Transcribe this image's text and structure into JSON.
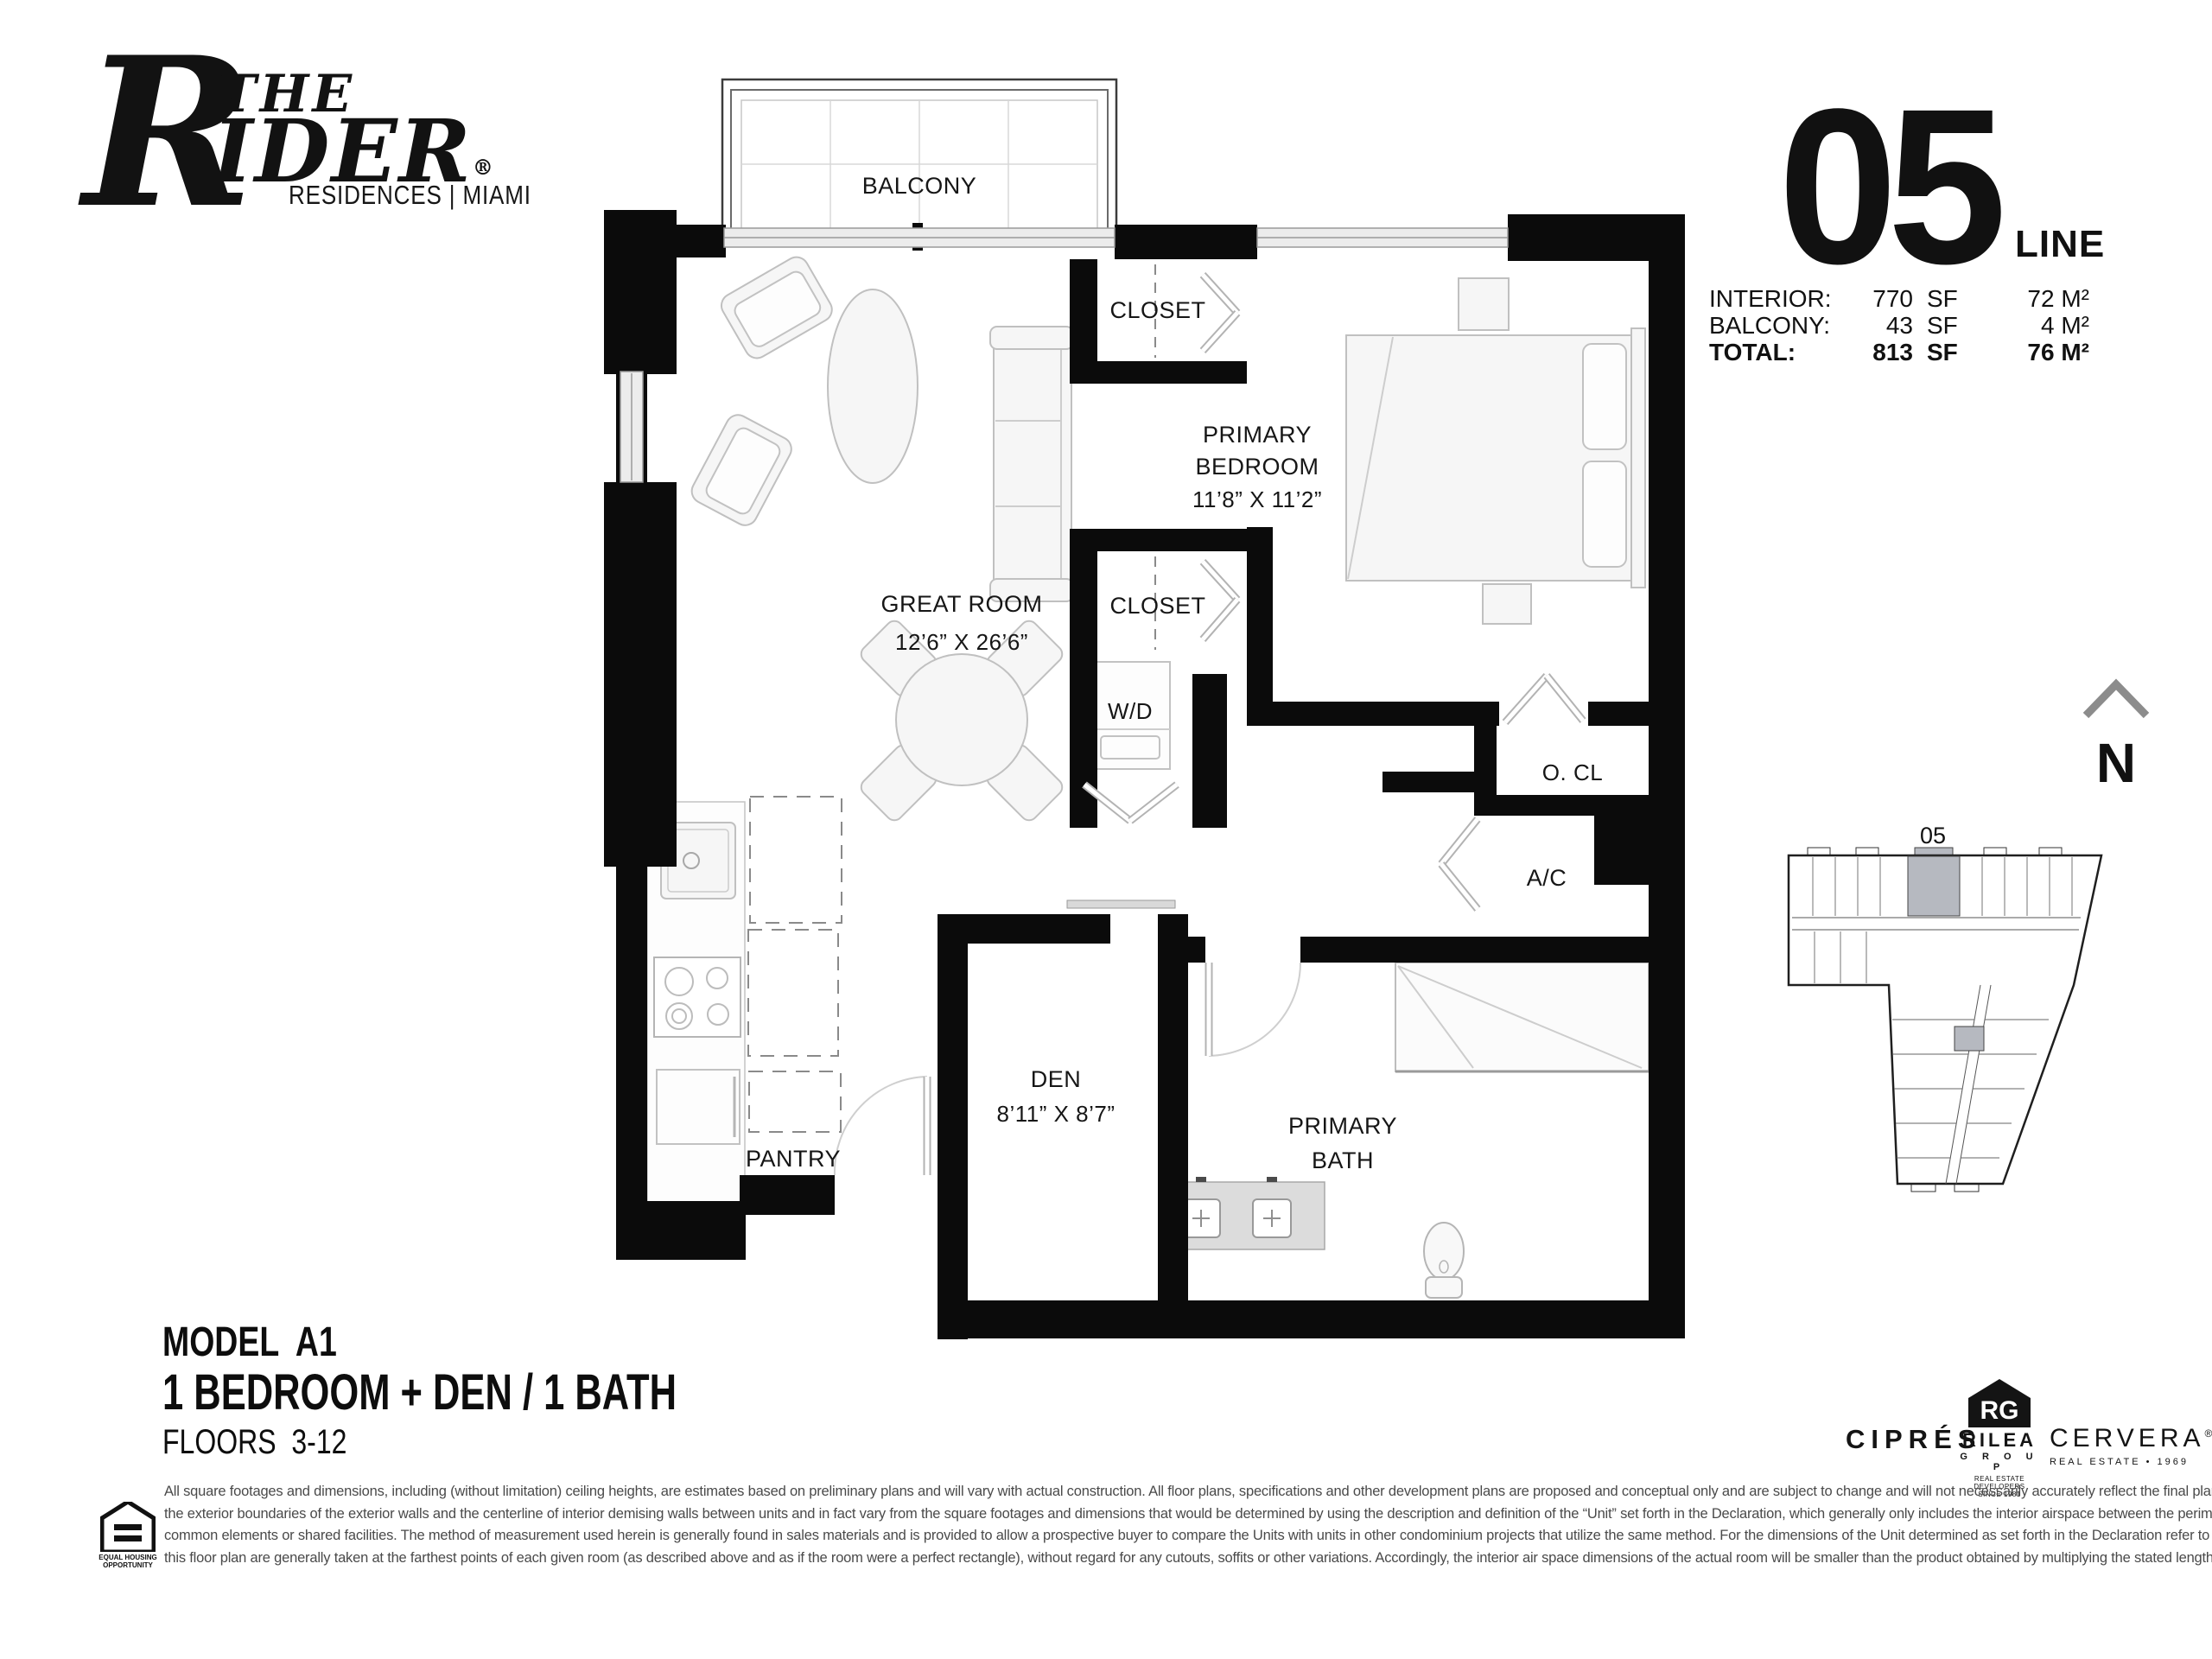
{
  "brand": {
    "rider_r": "R",
    "the": "THE",
    "rider_rest": "IDER",
    "reg": "®",
    "subtitle": "RESIDENCES | MIAMI"
  },
  "unit_header": {
    "number": "05",
    "line": "LINE"
  },
  "area_table": {
    "rows": [
      {
        "label": "INTERIOR:",
        "sf": "770",
        "sf_unit": "SF",
        "metric": "72 M²"
      },
      {
        "label": "BALCONY:",
        "sf": "43",
        "sf_unit": "SF",
        "metric": "4 M²"
      },
      {
        "label": "TOTAL:",
        "sf": "813",
        "sf_unit": "SF",
        "metric": "76 M²"
      }
    ]
  },
  "floorplan": {
    "balcony": "BALCONY",
    "closet_top": "CLOSET",
    "closet_bottom": "CLOSET",
    "primary_bedroom_line1": "PRIMARY",
    "primary_bedroom_line2": "BEDROOM",
    "primary_bedroom_dims": "11’8” X 11’2”",
    "great_room": "GREAT ROOM",
    "great_room_dims": "12’6” X 26’6”",
    "wd": "W/D",
    "ocl": "O. CL",
    "ac": "A/C",
    "den": "DEN",
    "den_dims": "8’11” X 8’7”",
    "primary_bath_line1": "PRIMARY",
    "primary_bath_line2": "BATH",
    "pantry": "PANTRY"
  },
  "compass": {
    "n": "N"
  },
  "keyplan": {
    "unit_label": "05"
  },
  "model_info": {
    "model": "MODEL  A1",
    "type": "1 BEDROOM + DEN / 1 BATH",
    "floors": "FLOORS  3-12"
  },
  "developers": {
    "cipres": "CIPRÉS",
    "rilea_icon": "RG",
    "rilea_name": "RILEA",
    "rilea_group": "G R O U P",
    "rilea_tag1": "REAL ESTATE DEVELOPERS",
    "rilea_tag2": "SINCE 1981",
    "cervera": "CERVERA",
    "cervera_reg": "®",
    "cervera_tag": "REAL ESTATE • 1969"
  },
  "equal_housing": {
    "l1": "EQUAL HOUSING",
    "l2": "OPPORTUNITY"
  },
  "disclaimer": {
    "lines": [
      "All square footages and dimensions, including (without limitation) ceiling heights, are estimates based on preliminary plans and will vary with actual construction. All floor plans, specifications and other development plans are proposed and conceptual only and are subject to change and will not necessarily accurately reflect the final plans and specifications. Stated square footages and dimensions are measured to",
      "the exterior boundaries of the exterior walls and the centerline of interior demising walls between units and in fact vary from the square footages and dimensions that would be determined by using the description and definition of the “Unit” set forth in the Declaration, which generally only includes the interior airspace between the perimeter walls and excludes all interior structural components and other",
      "common elements or shared facilities.  The method of measurement used herein is generally found in sales materials and is provided to allow a prospective buyer to compare the Units with units in other condominium projects that utilize the same method.  For the dimensions of the Unit determined as set forth in the Declaration refer to the prospectus documents.  Measurements of rooms set forth on",
      "this floor plan are generally taken at the farthest points of each given room (as described above and as if the room were a perfect rectangle), without regard for any cutouts, soffits or other variations.  Accordingly, the interior air space dimensions of the actual room will be smaller than the product obtained by multiplying the stated length and width.  Terraces and other exterior areas are not part of the Unit."
    ]
  }
}
